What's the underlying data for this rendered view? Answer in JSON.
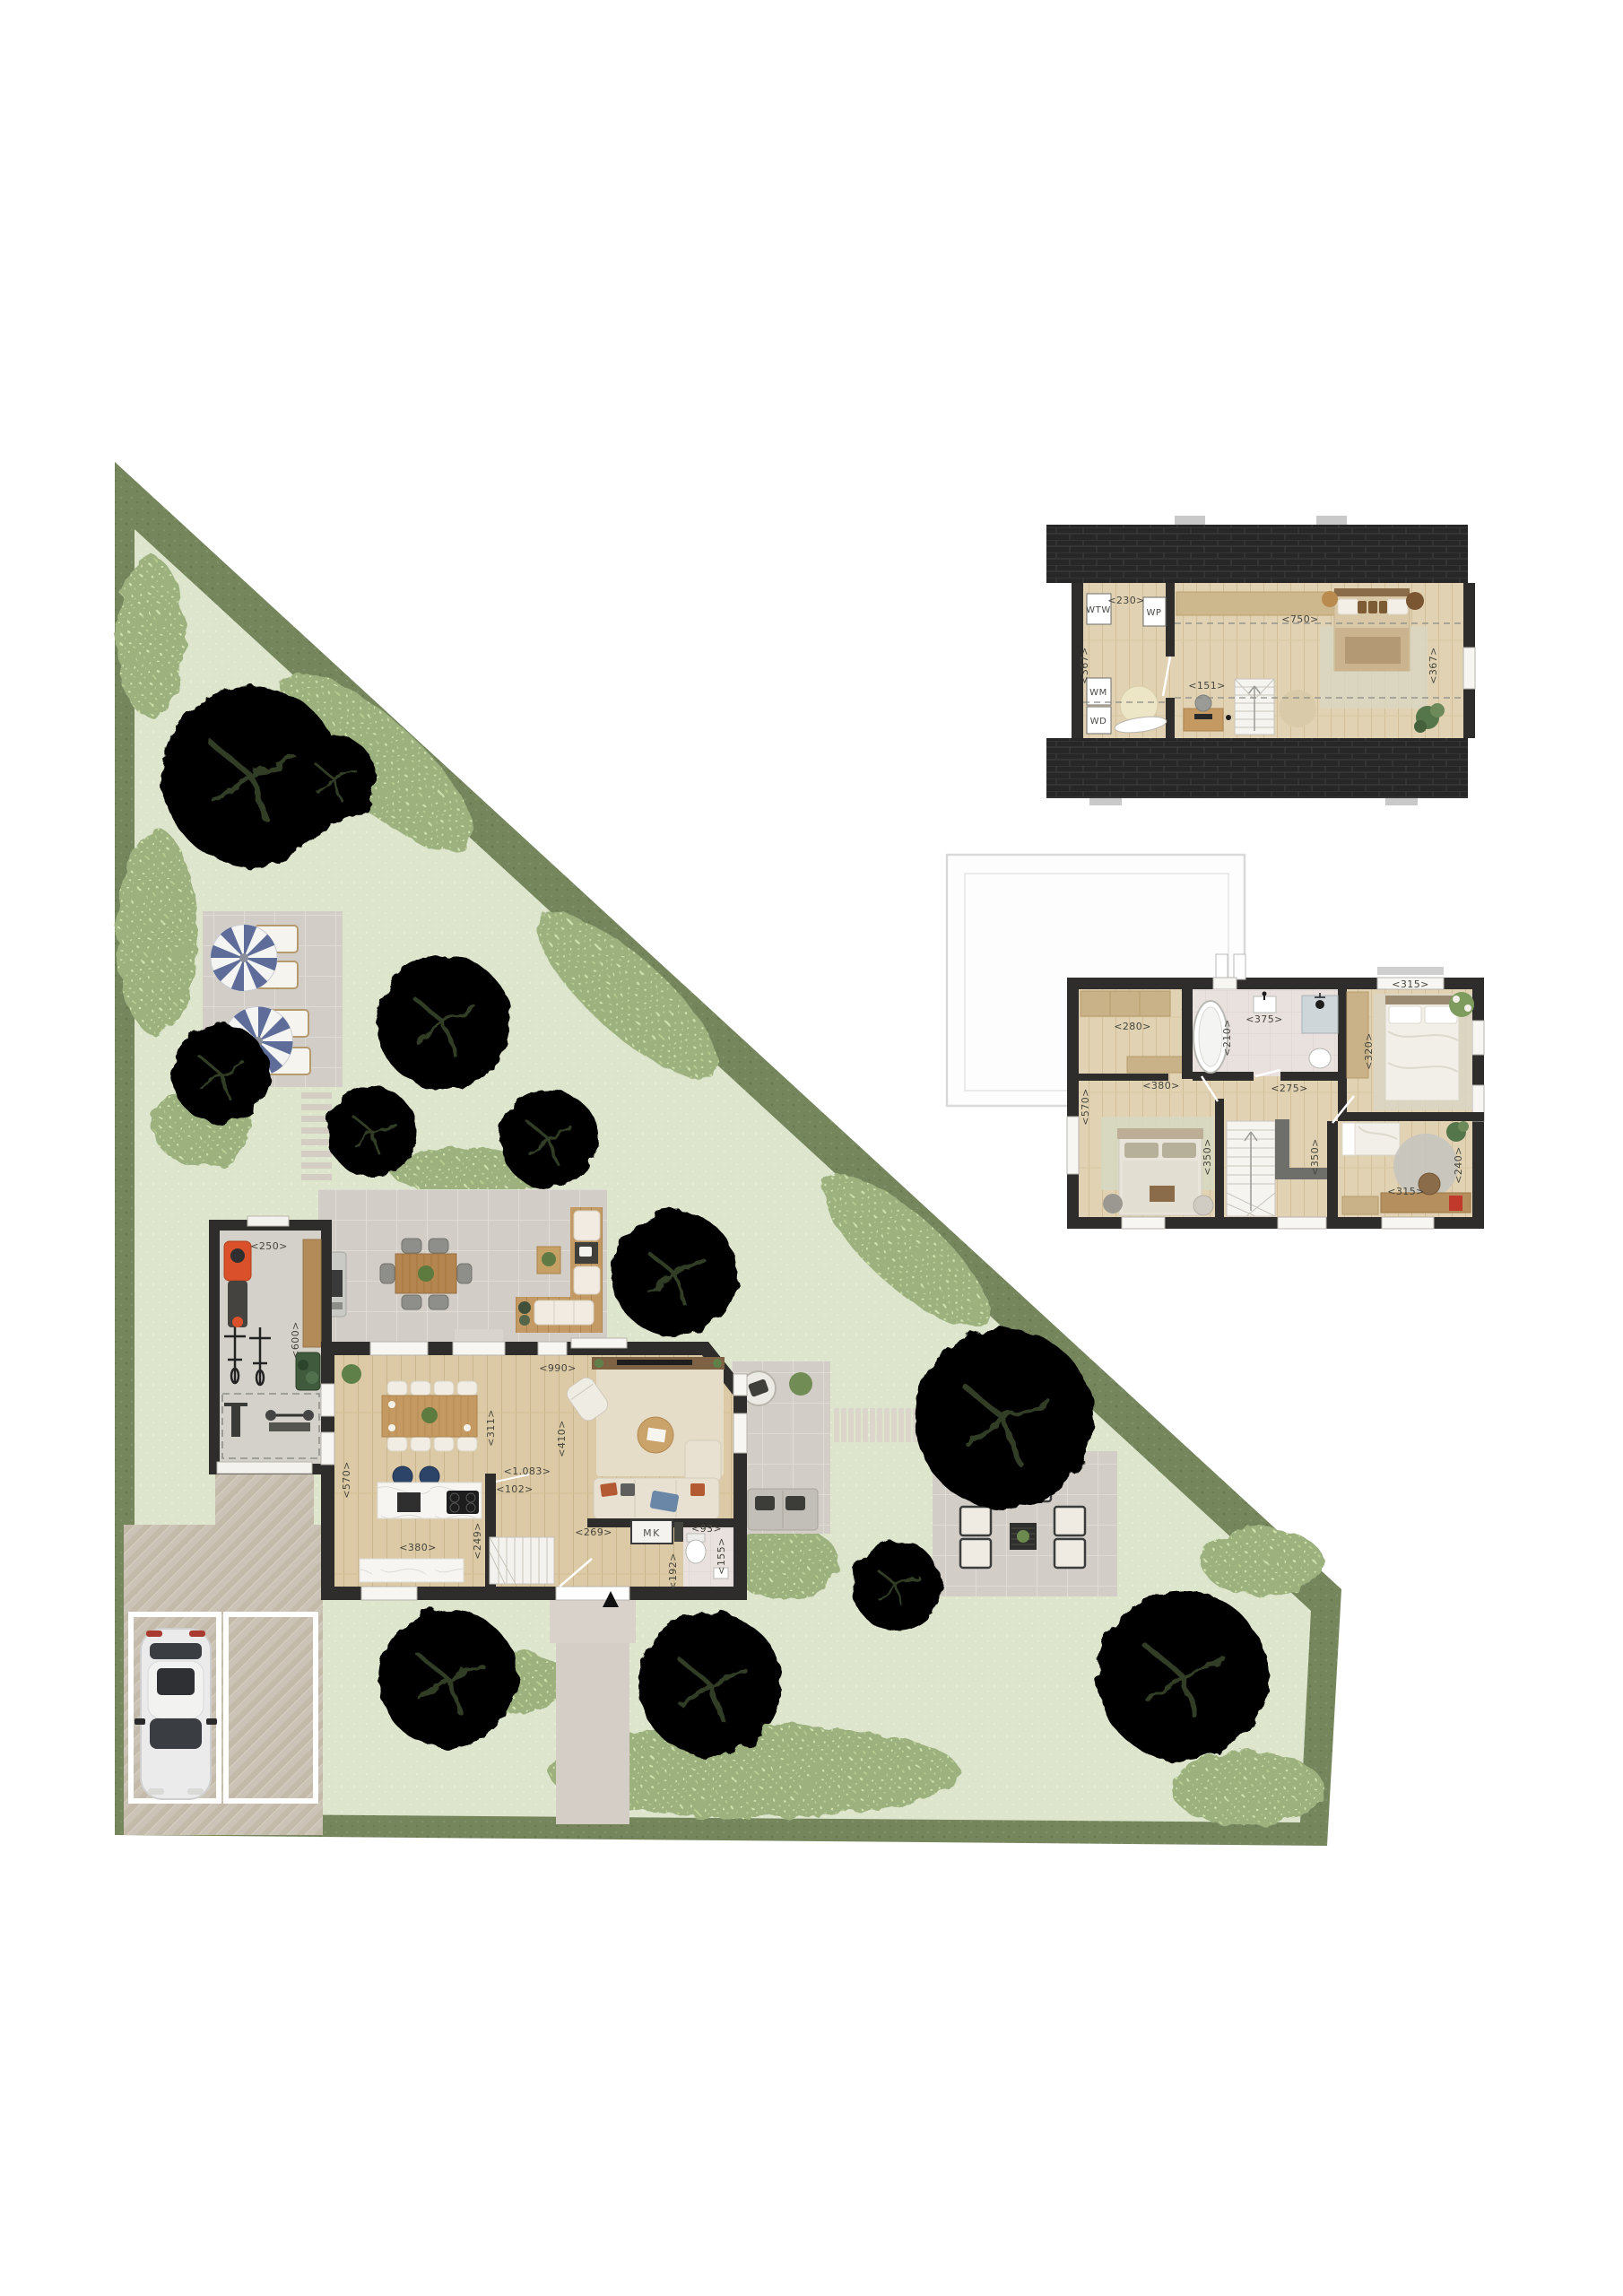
{
  "document": {
    "kind": "real-estate floor plan & garden site plan",
    "views": [
      "site plan with ground floor",
      "attic plan",
      "first floor plan"
    ]
  },
  "colors": {
    "hedge": "#75865d",
    "lawn": "#dde6cd",
    "shrub": "#9cb17e",
    "wall": "#2e2d2b",
    "roof": "#272727",
    "wood_floor": "#dcc9a5",
    "terrace_tile": "#d2cec7",
    "bath_tile": "#e9e1de",
    "deck_wood": "#c39a63",
    "herringbone_paving": "#cbc3b5",
    "parasol_blue": "#5d6c98",
    "car_body": "#ebebeb"
  },
  "plans": {
    "ground_floor": {
      "labels": {
        "mk": "MK"
      },
      "dims": {
        "d250": "<250>",
        "d600": "<600>",
        "d990": "<990>",
        "d311": "<311>",
        "d410": "<410>",
        "d570": "<570>",
        "d1083": "<1.083>",
        "d102": "<102>",
        "d249": "<249>",
        "d269": "<269>",
        "d380": "<380>",
        "d93": "<93>",
        "d155": "<155>",
        "d192": "<192>"
      }
    },
    "first_floor": {
      "dims": {
        "d280": "<280>",
        "d375": "<375>",
        "d210": "<210>",
        "d315t": "<315>",
        "d320": "<320>",
        "d570": "<570>",
        "d380": "<380>",
        "d275": "<275>",
        "d350l": "<350>",
        "d350r": "<350>",
        "d315b": "<315>",
        "d240": "<240>"
      }
    },
    "attic": {
      "appliances": {
        "wtw": "WTW",
        "wp": "WP",
        "wm": "WM",
        "wd": "WD"
      },
      "dims": {
        "d230": "<230>",
        "d367l": "<367>",
        "d151": "<151>",
        "d750": "<750>",
        "d367r": "<367>"
      }
    }
  }
}
